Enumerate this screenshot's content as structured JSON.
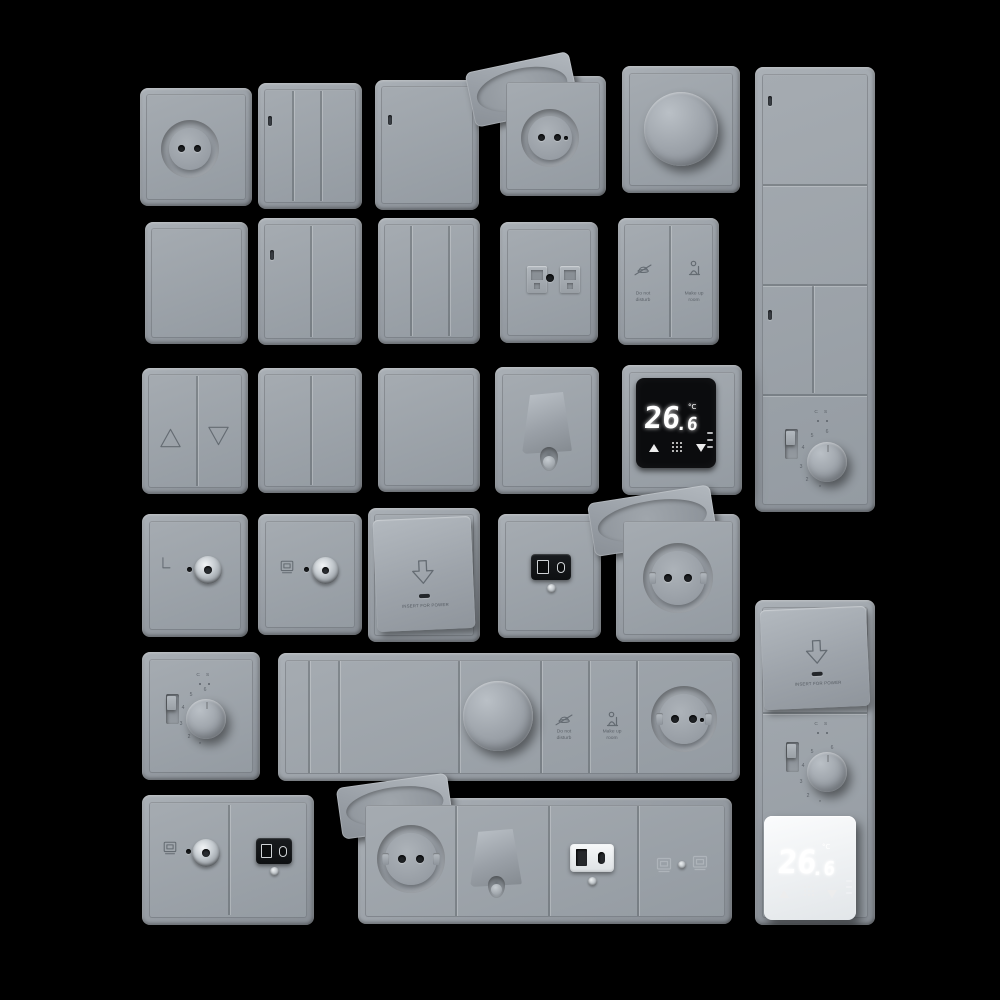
{
  "scene": {
    "background": "#000000",
    "plate_color": "#9ba1a8",
    "plate_highlight": "#b4bac0",
    "plate_shadow": "#7d838a",
    "engraving_color": "#646b72",
    "display_black": "#0b0c0e",
    "display_white": "#eef0f2",
    "digit_color": "#ffffff"
  },
  "labels": {
    "insert_for_power": "INSERT FOR POWER",
    "do_not_disturb": {
      "line1": "Do not",
      "line2": "disturb"
    },
    "make_up_room": {
      "line1": "Make up",
      "line2": "room"
    }
  },
  "thermostat_display": {
    "temp_main": "26",
    "temp_dec": ".6",
    "unit": "°C"
  },
  "thermostat_dial": {
    "marks": [
      "6",
      "5",
      "4",
      "3",
      "2",
      "*"
    ],
    "mode_marks": "C S"
  },
  "icons": {
    "do_not_disturb": "bell-slash-icon",
    "make_up_room": "housekeeping-icon",
    "data_port": "monitor-icon",
    "insert_card": "arrow-down-outline-icon",
    "blinds": "triangle-outline-icons",
    "display_controls": "triangle-up-down-and-dot-grid-icons"
  }
}
